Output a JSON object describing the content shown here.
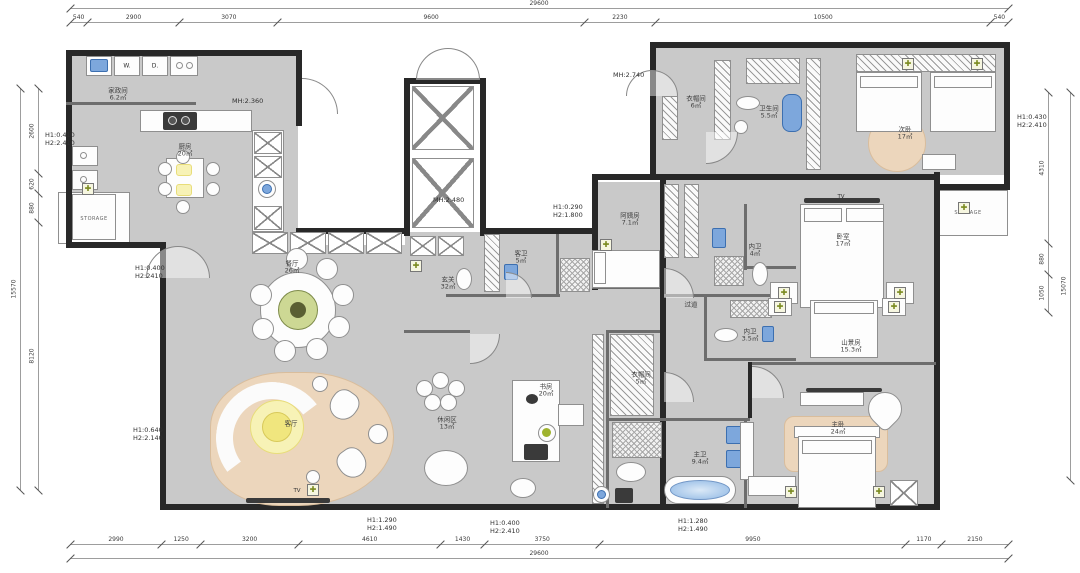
{
  "title": "residential floor plan",
  "colors": {
    "wall": "#282828",
    "floor": "#c9c9c9",
    "rug": "#ecd6bc",
    "glow": "#f0e67e",
    "fixture_blue": "#7da7dc",
    "accent_green": "#9fb32e",
    "dim_line": "#9d9d9d",
    "text": "#3f3f3f"
  },
  "plan": {
    "rooms": [
      {
        "name": "家政间",
        "area": "6.2㎡",
        "x": 118,
        "y": 95
      },
      {
        "name": "厨房",
        "area": "20㎡",
        "x": 185,
        "y": 151
      },
      {
        "name": "餐厅",
        "area": "26㎡",
        "x": 292,
        "y": 268
      },
      {
        "name": "客厅",
        "area": "",
        "x": 291,
        "y": 424
      },
      {
        "name": "休闲区",
        "area": "13㎡",
        "x": 447,
        "y": 424
      },
      {
        "name": "玄关",
        "area": "32㎡",
        "x": 448,
        "y": 284
      },
      {
        "name": "客卫",
        "area": "5㎡",
        "x": 521,
        "y": 258
      },
      {
        "name": "阿姨房",
        "area": "7.1㎡",
        "x": 630,
        "y": 220
      },
      {
        "name": "衣帽间",
        "area": "6㎡",
        "x": 696,
        "y": 103
      },
      {
        "name": "卫生间",
        "area": "5.5㎡",
        "x": 769,
        "y": 113
      },
      {
        "name": "次卧",
        "area": "17㎡",
        "x": 905,
        "y": 134
      },
      {
        "name": "卧室",
        "area": "17㎡",
        "x": 843,
        "y": 241
      },
      {
        "name": "内卫",
        "area": "4㎡",
        "x": 755,
        "y": 251
      },
      {
        "name": "过道",
        "area": "",
        "x": 691,
        "y": 305
      },
      {
        "name": "内卫",
        "area": "3.5㎡",
        "x": 750,
        "y": 336
      },
      {
        "name": "山景房",
        "area": "15.3㎡",
        "x": 851,
        "y": 347
      },
      {
        "name": "书房",
        "area": "20㎡",
        "x": 546,
        "y": 391
      },
      {
        "name": "衣帽间",
        "area": "5㎡",
        "x": 641,
        "y": 379
      },
      {
        "name": "主卫",
        "area": "9.4㎡",
        "x": 700,
        "y": 459
      },
      {
        "name": "主卧",
        "area": "24㎡",
        "x": 838,
        "y": 429
      }
    ],
    "annotations": [
      {
        "lines": [
          "H1:0.410",
          "H2:2.410"
        ],
        "x": 45,
        "y": 131
      },
      {
        "lines": [
          "H1:0.400",
          "H2:2410"
        ],
        "x": 135,
        "y": 264
      },
      {
        "lines": [
          "H1:0.640",
          "H2:2.140"
        ],
        "x": 133,
        "y": 426
      },
      {
        "lines": [
          "H1:0.290",
          "H2:1.800"
        ],
        "x": 553,
        "y": 203
      },
      {
        "lines": [
          "H1:0.430",
          "H2:2.410"
        ],
        "x": 1017,
        "y": 113
      },
      {
        "lines": [
          "H1:1.290",
          "H2:1.490"
        ],
        "x": 367,
        "y": 516
      },
      {
        "lines": [
          "H1:0.400",
          "H2:2.410"
        ],
        "x": 490,
        "y": 519
      },
      {
        "lines": [
          "H1:1.280",
          "H2:1.490"
        ],
        "x": 678,
        "y": 517
      }
    ],
    "mh_labels": [
      {
        "text": "MH:2.360",
        "x": 232,
        "y": 97
      },
      {
        "text": "MH:2.480",
        "x": 433,
        "y": 196
      },
      {
        "text": "MH:2.740",
        "x": 613,
        "y": 71
      }
    ],
    "tv_labels": [
      {
        "text": "TV",
        "x": 841,
        "y": 194
      },
      {
        "text": "TV",
        "x": 297,
        "y": 488
      }
    ],
    "appliance_labels": [
      {
        "text": "W.",
        "x": 127,
        "y": 66
      },
      {
        "text": "D.",
        "x": 155,
        "y": 66
      }
    ],
    "storage_labels": [
      {
        "text": "STORAGE",
        "x": 94,
        "y": 216
      },
      {
        "text": "STORAGE",
        "x": 968,
        "y": 210
      }
    ],
    "light_symbols": [
      {
        "x": 606,
        "y": 245
      },
      {
        "x": 416,
        "y": 266
      },
      {
        "x": 908,
        "y": 64
      },
      {
        "x": 977,
        "y": 64
      },
      {
        "x": 784,
        "y": 293
      },
      {
        "x": 900,
        "y": 293
      },
      {
        "x": 780,
        "y": 307
      },
      {
        "x": 894,
        "y": 307
      },
      {
        "x": 791,
        "y": 492
      },
      {
        "x": 879,
        "y": 492
      },
      {
        "x": 313,
        "y": 490
      },
      {
        "x": 88,
        "y": 189
      },
      {
        "x": 964,
        "y": 208
      }
    ],
    "dims": {
      "top": {
        "total": "29600",
        "segments": [
          "540",
          "2900",
          "3070",
          "9600",
          "2230",
          "10500",
          "540"
        ]
      },
      "bottom": {
        "total": "29600",
        "segments": [
          "2990",
          "1250",
          "3200",
          "4610",
          "1430",
          "3750",
          "9950",
          "1170",
          "2150"
        ]
      },
      "left": {
        "total": "15570",
        "segments": [
          "2600",
          "620",
          "880",
          "8120"
        ]
      },
      "right": {
        "total": "15070",
        "segments": [
          "4310",
          "880",
          "1050"
        ]
      }
    }
  }
}
